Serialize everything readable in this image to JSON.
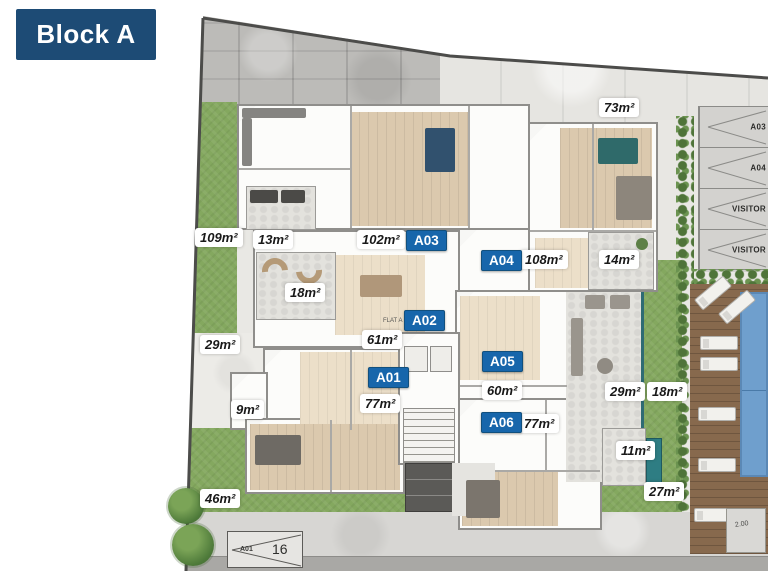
{
  "title": "Block A",
  "badges": {
    "a01": "A01",
    "a02": "A02",
    "a03": "A03",
    "a04": "A04",
    "a05": "A05",
    "a06": "A06"
  },
  "areas": {
    "yard_top_right": "73m²",
    "yard_left": "109m²",
    "balcony_a03": "13m²",
    "flat_a03": "102m²",
    "flat_a04": "108m²",
    "balcony_a04": "14m²",
    "terrace_a02": "18m²",
    "patio_left": "29m²",
    "flat_a02": "61m²",
    "flat_a01": "77m²",
    "balcony_a01": "9m²",
    "flat_a05": "60m²",
    "patio_a05": "29m²",
    "garden_a05": "18m²",
    "flat_a06": "77m²",
    "balcony_a06": "11m²",
    "patio_a06": "27m²",
    "yard_bottom": "46m²"
  },
  "parking": {
    "spaces": [
      {
        "label": "A03"
      },
      {
        "label": "A04"
      },
      {
        "label": "VISITOR"
      },
      {
        "label": "VISITOR"
      }
    ],
    "street": {
      "label": "A01",
      "number": "16"
    }
  },
  "notes": {
    "flat_tag": "FLAT A",
    "dim": "2.00"
  }
}
